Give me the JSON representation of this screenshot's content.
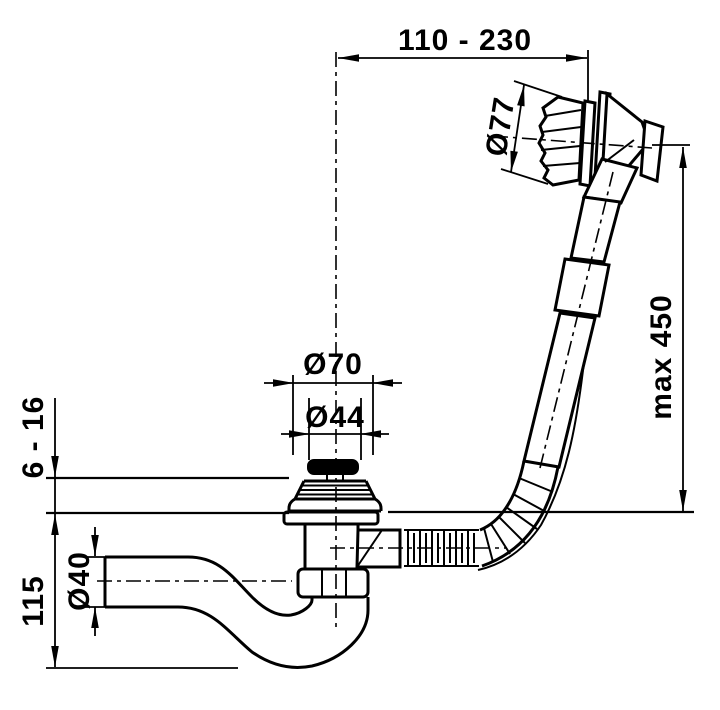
{
  "colors": {
    "ink": "#000000",
    "paper": "#ffffff"
  },
  "dimensions": {
    "offset_range": "110 - 230",
    "knob_diameter": "Ø77",
    "hose_max_length": "max 450",
    "hole_diameter": "Ø70",
    "plug_diameter": "Ø44",
    "rim_thickness": "6 - 16",
    "trap_height": "115",
    "pipe_diameter": "Ø40"
  }
}
